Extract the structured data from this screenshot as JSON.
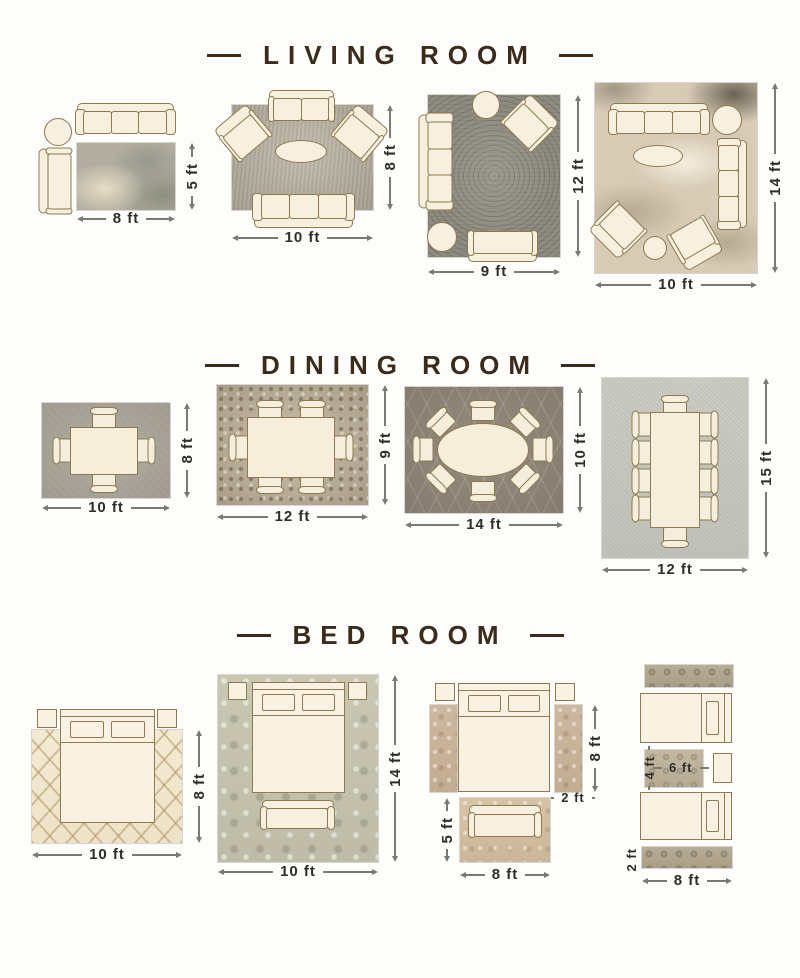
{
  "poster": {
    "type": "rug-size-guide-infographic",
    "colors": {
      "background": "#fdfdfc",
      "title_text": "#3b2b1b",
      "dimension_text": "#2f2d28",
      "furniture_fill": "#f8f0de",
      "furniture_outline": "#8d7a50"
    }
  },
  "sections": [
    {
      "title": "LIVING ROOM",
      "layouts": [
        {
          "id": "living-8x5",
          "width_label": "8 ft",
          "height_label": "5 ft"
        },
        {
          "id": "living-10x8",
          "width_label": "10 ft",
          "height_label": "8 ft"
        },
        {
          "id": "living-9x12",
          "width_label": "9 ft",
          "height_label": "12 ft"
        },
        {
          "id": "living-10x14",
          "width_label": "10 ft",
          "height_label": "14 ft"
        }
      ]
    },
    {
      "title": "DINING ROOM",
      "layouts": [
        {
          "id": "dining-10x8",
          "width_label": "10 ft",
          "height_label": "8 ft"
        },
        {
          "id": "dining-12x9",
          "width_label": "12 ft",
          "height_label": "9 ft"
        },
        {
          "id": "dining-14x10",
          "width_label": "14 ft",
          "height_label": "10 ft"
        },
        {
          "id": "dining-12x15",
          "width_label": "12 ft",
          "height_label": "15 ft"
        }
      ]
    },
    {
      "title": "BED ROOM",
      "layouts": [
        {
          "id": "bed-10x8",
          "width_label": "10 ft",
          "height_label": "8 ft"
        },
        {
          "id": "bed-10x14",
          "width_label": "10 ft",
          "height_label": "14 ft"
        },
        {
          "id": "bed-runners",
          "runner_height_label": "8 ft",
          "runner_width_label": "2 ft",
          "foot_rug_height_label": "5 ft",
          "foot_rug_width_label": "8 ft"
        },
        {
          "id": "bed-twin",
          "small_rug_height_label": "4 ft",
          "small_rug_width_label": "6 ft",
          "runner_width_label": "2 ft",
          "runner_length_label": "8 ft"
        }
      ]
    }
  ]
}
